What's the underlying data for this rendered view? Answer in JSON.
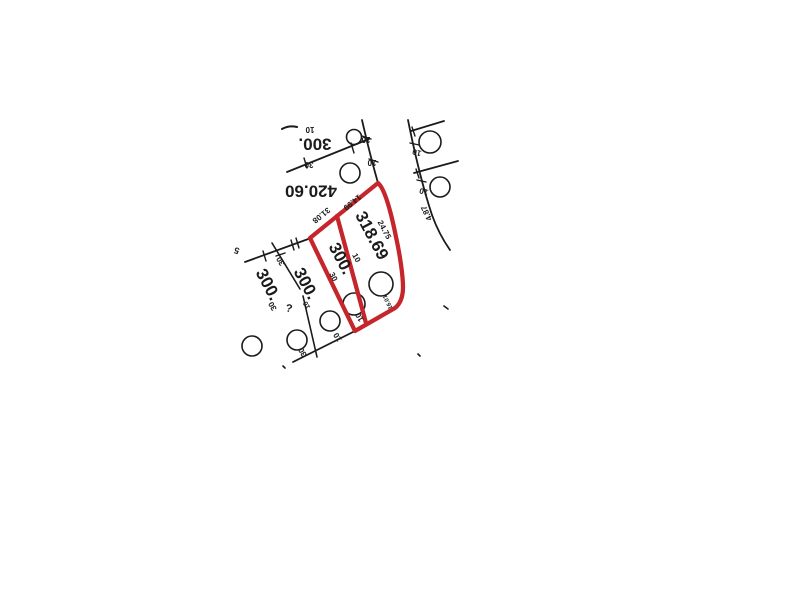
{
  "map": {
    "colors": {
      "ink": "#1b1b1b",
      "highlight_red": "#c5262c",
      "background": "#ffffff"
    },
    "labels": [
      {
        "name": "lot-area-label-top",
        "text": "300.",
        "x": 315,
        "y": 143,
        "rot": 180,
        "size": 17
      },
      {
        "name": "lot-area-label-42060",
        "text": "420.60",
        "x": 311,
        "y": 190,
        "rot": 180,
        "size": 17
      },
      {
        "name": "lot-area-label-31869",
        "text": "318.69",
        "x": 371,
        "y": 236,
        "rot": 62,
        "size": 17
      },
      {
        "name": "lot-area-label-300-red",
        "text": "300.",
        "x": 340,
        "y": 259,
        "rot": 62,
        "size": 17
      },
      {
        "name": "lot-area-label-300-mid",
        "text": "300.",
        "x": 305,
        "y": 284,
        "rot": 62,
        "size": 17
      },
      {
        "name": "lot-area-label-300-left",
        "text": "300.",
        "x": 267,
        "y": 285,
        "rot": 62,
        "size": 17
      },
      {
        "name": "dimension-label",
        "text": "24.75",
        "x": 384,
        "y": 230,
        "rot": 62,
        "size": 8
      },
      {
        "name": "dimension-label",
        "text": "31.08",
        "x": 321,
        "y": 215,
        "rot": 141,
        "size": 8
      },
      {
        "name": "dimension-label",
        "text": "14.99",
        "x": 352,
        "y": 202,
        "rot": 141,
        "size": 8
      },
      {
        "name": "dimension-label",
        "text": "4.87",
        "x": 427,
        "y": 213,
        "rot": 245,
        "size": 8
      },
      {
        "name": "dimension-label",
        "text": "10",
        "x": 310,
        "y": 129,
        "rot": 180,
        "size": 8
      },
      {
        "name": "dimension-label",
        "text": "30",
        "x": 309,
        "y": 164,
        "rot": 180,
        "size": 8
      },
      {
        "name": "dimension-label",
        "text": "10",
        "x": 366,
        "y": 139,
        "rot": 180,
        "size": 8
      },
      {
        "name": "dimension-label",
        "text": "10",
        "x": 372,
        "y": 162,
        "rot": 180,
        "size": 8
      },
      {
        "name": "dimension-label",
        "text": "10",
        "x": 417,
        "y": 152,
        "rot": 195,
        "size": 8
      },
      {
        "name": "dimension-label",
        "text": "10",
        "x": 424,
        "y": 191,
        "rot": 195,
        "size": 8
      },
      {
        "name": "dimension-label",
        "text": "10",
        "x": 356,
        "y": 258,
        "rot": 62,
        "size": 8
      },
      {
        "name": "dimension-label",
        "text": "30",
        "x": 333,
        "y": 277,
        "rot": 62,
        "size": 8
      },
      {
        "name": "dimension-label",
        "text": "10",
        "x": 360,
        "y": 317,
        "rot": 240,
        "size": 8
      },
      {
        "name": "dimension-label",
        "text": "10",
        "x": 338,
        "y": 337,
        "rot": 240,
        "size": 8
      },
      {
        "name": "dimension-label",
        "text": "30",
        "x": 303,
        "y": 352,
        "rot": 240,
        "size": 8
      },
      {
        "name": "dimension-label",
        "text": "30",
        "x": 281,
        "y": 261,
        "rot": 240,
        "size": 8
      },
      {
        "name": "dimension-label",
        "text": "30",
        "x": 273,
        "y": 306,
        "rot": 240,
        "size": 8
      },
      {
        "name": "dimension-label",
        "text": "16.01",
        "x": 388,
        "y": 302,
        "rot": 245,
        "size": 6
      },
      {
        "name": "scan-mark",
        "text": "?",
        "x": 289,
        "y": 309,
        "rot": 10,
        "size": 11
      },
      {
        "name": "dimension-label",
        "text": "10",
        "x": 307,
        "y": 305,
        "rot": 240,
        "size": 7
      },
      {
        "name": "scan-mark",
        "text": "5",
        "x": 237,
        "y": 250,
        "rot": 200,
        "size": 9
      }
    ],
    "ink_lines": [
      {
        "name": "boundary-dash-top",
        "d": "M282 129 Q289 125 297 127",
        "w": 2
      },
      {
        "name": "lot-line",
        "d": "M287 172 L369 139",
        "w": 1.8
      },
      {
        "name": "tick-mark",
        "d": "M304 158 l3 10",
        "w": 1.4
      },
      {
        "name": "tick-mark",
        "d": "M351 143 l3 10",
        "w": 1.4
      },
      {
        "name": "street-edge-west",
        "d": "M362 120 C367 142 372 162 378 183",
        "w": 1.8
      },
      {
        "name": "tick-mark",
        "d": "M362 136 l9 3",
        "w": 1.4
      },
      {
        "name": "tick-mark",
        "d": "M369 159 l9 3",
        "w": 1.4
      },
      {
        "name": "street-edge-east",
        "d": "M408 120 C414 150 421 182 432 215",
        "w": 1.8
      },
      {
        "name": "street-edge-east",
        "d": "M432 215 C437 229 443 240 450 250",
        "w": 1.8
      },
      {
        "name": "tick-mark",
        "d": "M410 143 l9 2",
        "w": 1.4
      },
      {
        "name": "tick-mark",
        "d": "M417 180 l9 2",
        "w": 1.4
      },
      {
        "name": "lot-line",
        "d": "M411 131 L444 121",
        "w": 1.8
      },
      {
        "name": "lot-line",
        "d": "M414 173 L458 161",
        "w": 1.8
      },
      {
        "name": "tick-mark",
        "d": "M412 127 l3 9",
        "w": 1.4
      },
      {
        "name": "tick-mark",
        "d": "M416 169 l3 9",
        "w": 1.4
      },
      {
        "name": "lot-line",
        "d": "M245 262 L311 238",
        "w": 1.8
      },
      {
        "name": "tick-mark",
        "d": "M291 240 l3 10",
        "w": 1.4
      },
      {
        "name": "tick-mark",
        "d": "M296 238 l3 10",
        "w": 1.4
      },
      {
        "name": "tick-mark",
        "d": "M263 251 l3 10",
        "w": 1.4
      },
      {
        "name": "lot-line",
        "d": "M272 243 L300 289",
        "w": 1.6
      },
      {
        "name": "lot-line",
        "d": "M303 296 L317 357",
        "w": 1.6
      },
      {
        "name": "tick-mark",
        "d": "M276 256 l9 -3",
        "w": 1.4
      },
      {
        "name": "lot-line-frontage",
        "d": "M293 362 L355 331",
        "w": 1.8
      },
      {
        "name": "scan-dot",
        "d": "M283 366 l2 2",
        "w": 1.6
      },
      {
        "name": "scan-dot",
        "d": "M444 306 l4 3",
        "w": 1.6
      },
      {
        "name": "scan-dot",
        "d": "M418 354 l2 2",
        "w": 1.6
      }
    ],
    "highlight_lines": [
      {
        "name": "highlighted-parcel-outline",
        "d": "M310 238 L378 183 C385 189 391 212 396 237 C400 255 403 276 403 287 C403 297 400 304 395 308 L355 331 Z",
        "w": 4.3
      },
      {
        "name": "highlighted-parcel-divider",
        "d": "M337 216 L366 323",
        "w": 4.3
      }
    ],
    "circles": [
      {
        "name": "lot-circle-symbol",
        "cx": 354,
        "cy": 137,
        "r": 7.5
      },
      {
        "name": "lot-circle-symbol",
        "cx": 350,
        "cy": 173,
        "r": 10
      },
      {
        "name": "lot-circle-symbol",
        "cx": 430,
        "cy": 142,
        "r": 11
      },
      {
        "name": "lot-circle-symbol",
        "cx": 440,
        "cy": 187,
        "r": 10
      },
      {
        "name": "lot-circle-symbol",
        "cx": 381,
        "cy": 284,
        "r": 12
      },
      {
        "name": "lot-circle-symbol",
        "cx": 354,
        "cy": 304,
        "r": 11
      },
      {
        "name": "lot-circle-symbol",
        "cx": 330,
        "cy": 321,
        "r": 10
      },
      {
        "name": "lot-circle-symbol",
        "cx": 297,
        "cy": 340,
        "r": 10
      },
      {
        "name": "lot-circle-symbol",
        "cx": 252,
        "cy": 346,
        "r": 10
      }
    ]
  }
}
